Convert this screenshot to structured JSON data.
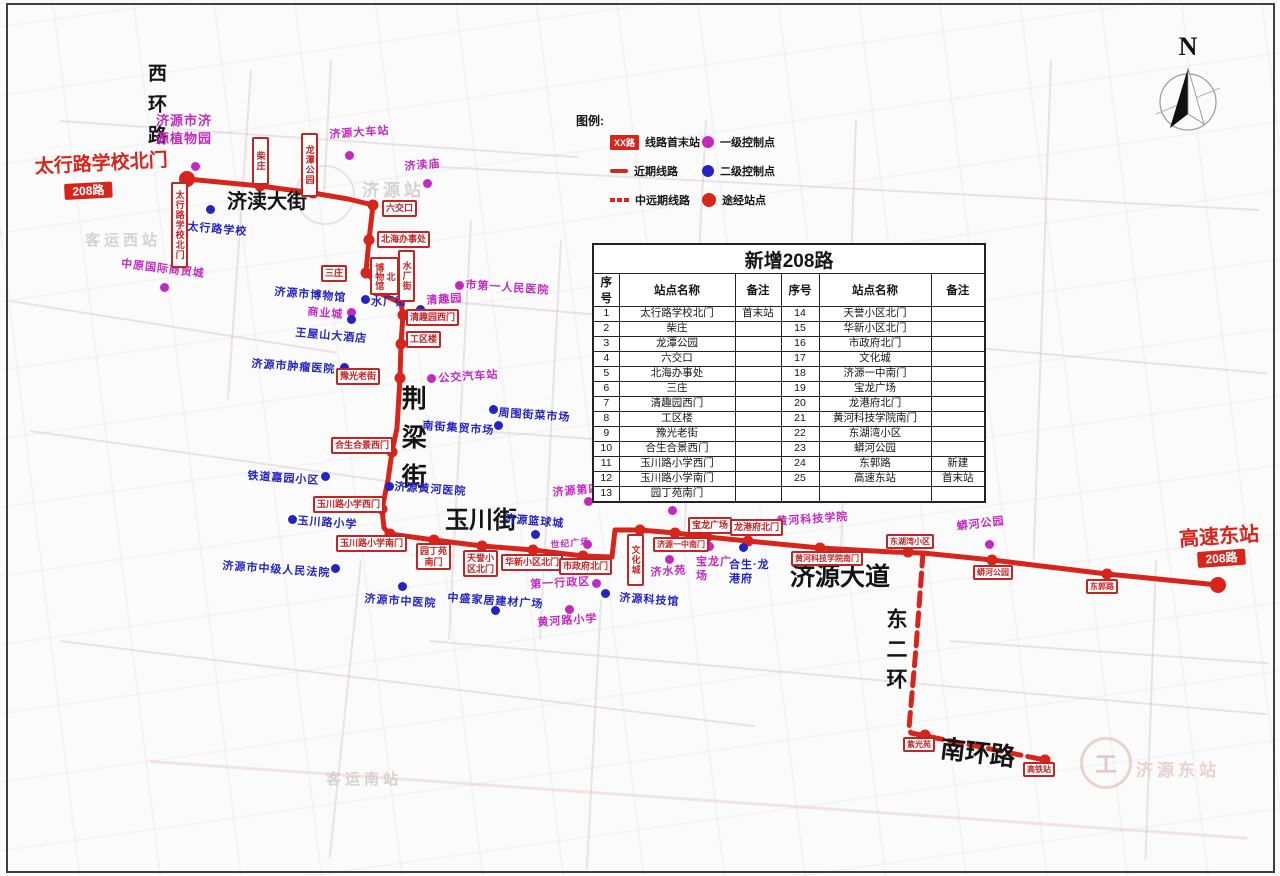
{
  "colors": {
    "route": "#d8251b",
    "station_border": "#c32424",
    "level1": "#c428c4",
    "level2": "#2323c4",
    "street": "#141414"
  },
  "compass": {
    "label": "N"
  },
  "legend": {
    "heading": "图例:",
    "items": [
      {
        "symbol": "terminus-box",
        "symbol_text": "XX路",
        "label": "线路首末站"
      },
      {
        "symbol": "solid-line",
        "label": "近期线路"
      },
      {
        "symbol": "dashed-line",
        "label": "中远期线路"
      },
      {
        "symbol": "magenta-dot",
        "label": "一级控制点"
      },
      {
        "symbol": "blue-dot",
        "label": "二级控制点"
      },
      {
        "symbol": "red-dot",
        "label": "途经站点"
      }
    ]
  },
  "table": {
    "title": "新增208路",
    "headers": [
      "序号",
      "站点名称",
      "备注",
      "序号",
      "站点名称",
      "备注"
    ],
    "rows": [
      [
        "1",
        "太行路学校北门",
        "首末站",
        "14",
        "天誉小区北门",
        ""
      ],
      [
        "2",
        "柴庄",
        "",
        "15",
        "华新小区北门",
        ""
      ],
      [
        "3",
        "龙潭公园",
        "",
        "16",
        "市政府北门",
        ""
      ],
      [
        "4",
        "六交口",
        "",
        "17",
        "文化城",
        ""
      ],
      [
        "5",
        "北海办事处",
        "",
        "18",
        "济源一中南门",
        ""
      ],
      [
        "6",
        "三庄",
        "",
        "19",
        "宝龙广场",
        ""
      ],
      [
        "7",
        "清趣园西门",
        "",
        "20",
        "龙港府北门",
        ""
      ],
      [
        "8",
        "工区楼",
        "",
        "21",
        "黄河科技学院南门",
        ""
      ],
      [
        "9",
        "豫光老街",
        "",
        "22",
        "东湖湾小区",
        ""
      ],
      [
        "10",
        "合生合景西门",
        "",
        "23",
        "蟒河公园",
        ""
      ],
      [
        "11",
        "玉川路小学西门",
        "",
        "24",
        "东郭路",
        "新建"
      ],
      [
        "12",
        "玉川路小学南门",
        "",
        "25",
        "高速东站",
        "首末站"
      ],
      [
        "13",
        "园丁苑南门",
        "",
        "",
        "",
        ""
      ]
    ]
  },
  "terminals": [
    {
      "name": "太行路学校北门",
      "x": 34,
      "y": 152,
      "size": 19,
      "rotate": -3,
      "badge": "208路",
      "bx": 64,
      "by": 184
    },
    {
      "name": "高速东站",
      "x": 1178,
      "y": 523,
      "size": 20,
      "rotate": -4,
      "badge": "208路",
      "bx": 1197,
      "by": 552
    }
  ],
  "map": {
    "route": {
      "main": [
        [
          187,
          179
        ],
        [
          260,
          186
        ],
        [
          313,
          193
        ],
        [
          348,
          199
        ],
        [
          373,
          205
        ],
        [
          369,
          240
        ],
        [
          366,
          272
        ],
        [
          377,
          284
        ],
        [
          377,
          292
        ],
        [
          401,
          303
        ],
        [
          403,
          315
        ],
        [
          401,
          344
        ],
        [
          400,
          378
        ],
        [
          397,
          428
        ],
        [
          392,
          452
        ],
        [
          388,
          480
        ],
        [
          382,
          509
        ],
        [
          384,
          528
        ],
        [
          390,
          534
        ],
        [
          434,
          540
        ],
        [
          482,
          546
        ],
        [
          533,
          550
        ],
        [
          583,
          556
        ],
        [
          612,
          557
        ],
        [
          615,
          530
        ],
        [
          640,
          530
        ],
        [
          675,
          533
        ],
        [
          707,
          537
        ],
        [
          748,
          541
        ],
        [
          820,
          548
        ],
        [
          893,
          552
        ],
        [
          923,
          553
        ],
        [
          992,
          560
        ],
        [
          1107,
          574
        ],
        [
          1218,
          585
        ]
      ],
      "branch": [
        [
          923,
          553
        ],
        [
          916,
          648
        ],
        [
          909,
          728
        ],
        [
          911,
          733
        ],
        [
          1045,
          760
        ]
      ],
      "stops": [
        [
          260,
          186
        ],
        [
          313,
          193
        ],
        [
          373,
          205
        ],
        [
          369,
          240
        ],
        [
          366,
          273
        ],
        [
          377,
          291
        ],
        [
          403,
          315
        ],
        [
          401,
          344
        ],
        [
          400,
          378
        ],
        [
          392,
          452
        ],
        [
          382,
          509
        ],
        [
          390,
          534
        ],
        [
          434,
          540
        ],
        [
          482,
          546
        ],
        [
          533,
          550
        ],
        [
          583,
          556
        ],
        [
          640,
          530
        ],
        [
          675,
          533
        ],
        [
          707,
          537
        ],
        [
          748,
          541
        ],
        [
          820,
          548
        ],
        [
          908,
          552
        ],
        [
          992,
          560
        ],
        [
          1107,
          574
        ],
        [
          925,
          735
        ],
        [
          1045,
          760
        ]
      ],
      "terminals": [
        [
          187,
          179
        ],
        [
          1218,
          585
        ]
      ]
    },
    "stations": [
      {
        "label": "太行路学校北门",
        "x": 171,
        "y": 182,
        "vertical": true,
        "h": 78
      },
      {
        "label": "柴庄",
        "x": 252,
        "y": 137,
        "vertical": true,
        "h": 40
      },
      {
        "label": "龙潭公园",
        "x": 301,
        "y": 133,
        "vertical": true,
        "h": 56
      },
      {
        "label": "六交口",
        "x": 382,
        "y": 200
      },
      {
        "label": "北海办事处",
        "x": 377,
        "y": 231
      },
      {
        "label": "三庄",
        "x": 321,
        "y": 265
      },
      {
        "label": "博物馆北",
        "x": 370,
        "y": 257,
        "twocol": true,
        "h": 32
      },
      {
        "label": "水厂街",
        "x": 398,
        "y": 250,
        "vertical": true,
        "h": 44
      },
      {
        "label": "清趣园西门",
        "x": 406,
        "y": 309
      },
      {
        "label": "工区楼",
        "x": 406,
        "y": 331
      },
      {
        "label": "豫光老街",
        "x": 336,
        "y": 368
      },
      {
        "label": "合生合景西门",
        "x": 331,
        "y": 437
      },
      {
        "label": "玉川路小学西门",
        "x": 313,
        "y": 496
      },
      {
        "label": "玉川路小学南门",
        "x": 336,
        "y": 535
      },
      {
        "label": "园丁苑\n南门",
        "x": 416,
        "y": 543
      },
      {
        "label": "天誉小\n区北门",
        "x": 463,
        "y": 550
      },
      {
        "label": "华新小区北门",
        "x": 501,
        "y": 554
      },
      {
        "label": "市政府北门",
        "x": 559,
        "y": 558
      },
      {
        "label": "文化城",
        "x": 627,
        "y": 534,
        "vertical": true,
        "h": 44
      },
      {
        "label": "济源一中南门",
        "x": 653,
        "y": 537,
        "small": true
      },
      {
        "label": "宝龙广场",
        "x": 688,
        "y": 517
      },
      {
        "label": "龙港府北门",
        "x": 730,
        "y": 519
      },
      {
        "label": "黄河科技学院南门",
        "x": 791,
        "y": 551,
        "small": true
      },
      {
        "label": "东湖湾小区",
        "x": 886,
        "y": 534,
        "small": true
      },
      {
        "label": "蟒河公园",
        "x": 973,
        "y": 565,
        "small": true
      },
      {
        "label": "东郭路",
        "x": 1086,
        "y": 579,
        "small": true
      },
      {
        "label": "紫光苑",
        "x": 903,
        "y": 737,
        "small": true
      },
      {
        "label": "高铁站",
        "x": 1023,
        "y": 762,
        "small": true
      }
    ],
    "pois": [
      {
        "text": "济源市济\n源植物园",
        "x": 156,
        "y": 112,
        "color": "m",
        "dot": [
          196,
          167
        ],
        "big": true
      },
      {
        "text": "济源大车站",
        "x": 329,
        "y": 128,
        "color": "m",
        "dot": [
          350,
          156
        ],
        "rotate": -4
      },
      {
        "text": "济渎庙",
        "x": 404,
        "y": 160,
        "color": "m",
        "dot": [
          428,
          184
        ],
        "rotate": -5
      },
      {
        "text": "中原国际商贸城",
        "x": 122,
        "y": 257,
        "color": "m",
        "dot": [
          165,
          288
        ],
        "rotate": 7
      },
      {
        "text": "市第一人民医院",
        "x": 466,
        "y": 278,
        "color": "m",
        "dot": [
          460,
          286
        ],
        "rotate": 4
      },
      {
        "text": "清趣园",
        "x": 426,
        "y": 294,
        "color": "m",
        "dot": [
          421,
          310
        ],
        "dotcolor": "b",
        "rotate": -4
      },
      {
        "text": "商业城",
        "x": 308,
        "y": 305,
        "color": "m",
        "dot": [
          352,
          313
        ],
        "rotate": 5
      },
      {
        "text": "公交汽车站",
        "x": 438,
        "y": 372,
        "color": "m",
        "dot": [
          432,
          379
        ],
        "rotate": -4
      },
      {
        "text": "济源第四中学",
        "x": 552,
        "y": 486,
        "color": "m",
        "dot": [
          589,
          502
        ],
        "rotate": -5
      },
      {
        "text": "济源市一中",
        "x": 643,
        "y": 492,
        "color": "m",
        "dot": [
          673,
          511
        ],
        "rotate": -5
      },
      {
        "text": "世纪广场",
        "x": 550,
        "y": 540,
        "color": "m",
        "dot": [
          588,
          545
        ],
        "small": true,
        "rotate": -5
      },
      {
        "text": "第一行政区",
        "x": 530,
        "y": 578,
        "color": "m",
        "dot": [
          597,
          584
        ],
        "rotate": -3
      },
      {
        "text": "济水苑",
        "x": 650,
        "y": 566,
        "color": "m",
        "dot": [
          670,
          560
        ],
        "rotate": -4
      },
      {
        "text": "宝龙广\n场",
        "x": 696,
        "y": 555,
        "color": "m",
        "dot": [
          710,
          547
        ]
      },
      {
        "text": "黄河科技学院",
        "x": 776,
        "y": 515,
        "color": "m",
        "rotate": -4
      },
      {
        "text": "黄河路小学",
        "x": 537,
        "y": 616,
        "color": "m",
        "dot": [
          570,
          610
        ],
        "rotate": -4
      },
      {
        "text": "蟒河公园",
        "x": 956,
        "y": 520,
        "color": "m",
        "dot": [
          990,
          545
        ],
        "rotate": -7
      },
      {
        "text": "太行路学校",
        "x": 188,
        "y": 220,
        "color": "b",
        "dot": [
          211,
          210
        ],
        "rotate": 5
      },
      {
        "text": "济源市博物馆",
        "x": 275,
        "y": 285,
        "color": "b",
        "rotate": 5
      },
      {
        "text": "水厂街",
        "x": 371,
        "y": 295,
        "color": "b",
        "dot": [
          366,
          300
        ]
      },
      {
        "text": "王屋山大酒店",
        "x": 296,
        "y": 326,
        "color": "b",
        "dot": [
          352,
          320
        ],
        "rotate": 5
      },
      {
        "text": "济源市肿瘤医院",
        "x": 252,
        "y": 357,
        "color": "b",
        "dot": [
          345,
          368
        ],
        "rotate": 4
      },
      {
        "text": "周围街菜市场",
        "x": 499,
        "y": 406,
        "color": "b",
        "dot": [
          494,
          410
        ],
        "rotate": 4
      },
      {
        "text": "南街集贸市场",
        "x": 423,
        "y": 419,
        "color": "b",
        "dot": [
          499,
          426
        ],
        "rotate": 4
      },
      {
        "text": "铁道嘉园小区",
        "x": 248,
        "y": 469,
        "color": "b",
        "dot": [
          326,
          477
        ],
        "rotate": 4
      },
      {
        "text": "济源黄河医院",
        "x": 395,
        "y": 480,
        "color": "b",
        "dot": [
          390,
          487
        ],
        "rotate": 4
      },
      {
        "text": "玉川路小学",
        "x": 298,
        "y": 514,
        "color": "b",
        "dot": [
          293,
          520
        ],
        "rotate": 4
      },
      {
        "text": "济源篮球城",
        "x": 505,
        "y": 512,
        "color": "b",
        "dot": [
          536,
          535
        ],
        "rotate": 5
      },
      {
        "text": "济源市中级人民法院",
        "x": 223,
        "y": 559,
        "color": "b",
        "dot": [
          336,
          569
        ],
        "rotate": 4
      },
      {
        "text": "济源市中医院",
        "x": 365,
        "y": 592,
        "color": "b",
        "dot": [
          403,
          587
        ],
        "rotate": 4
      },
      {
        "text": "中盛家居建材广场",
        "x": 448,
        "y": 591,
        "color": "b",
        "dot": [
          496,
          611
        ],
        "rotate": 4
      },
      {
        "text": "济源科技馆",
        "x": 620,
        "y": 591,
        "color": "b",
        "dot": [
          606,
          594
        ],
        "rotate": 4
      },
      {
        "text": "合生·龙\n港府",
        "x": 729,
        "y": 558,
        "color": "b",
        "dot": [
          744,
          548
        ]
      }
    ],
    "streets": [
      {
        "text": "西环路",
        "x": 145,
        "y": 63,
        "size": 19,
        "vertical": true,
        "spacing": 12
      },
      {
        "text": "济渎大街",
        "x": 227,
        "y": 192,
        "size": 20
      },
      {
        "text": "荆梁街",
        "x": 399,
        "y": 385,
        "size": 25,
        "vertical": true,
        "spacing": 14
      },
      {
        "text": "玉川街",
        "x": 445,
        "y": 508,
        "size": 24
      },
      {
        "text": "济源大道",
        "x": 790,
        "y": 564,
        "size": 25
      },
      {
        "text": "东二环",
        "x": 884,
        "y": 608,
        "size": 21,
        "vertical": true,
        "spacing": 9
      },
      {
        "text": "南环路",
        "x": 942,
        "y": 736,
        "size": 25,
        "rotate": 7
      }
    ],
    "watermarks": [
      {
        "text": "济源站",
        "x": 362,
        "y": 176,
        "size": 17
      },
      {
        "text": "客运西站",
        "x": 85,
        "y": 229,
        "size": 15
      },
      {
        "text": "客运南站",
        "x": 326,
        "y": 768,
        "size": 15
      },
      {
        "text": "济源东站",
        "x": 1136,
        "y": 756,
        "size": 17,
        "pink": true
      }
    ],
    "train_logo_glyph": "工"
  }
}
